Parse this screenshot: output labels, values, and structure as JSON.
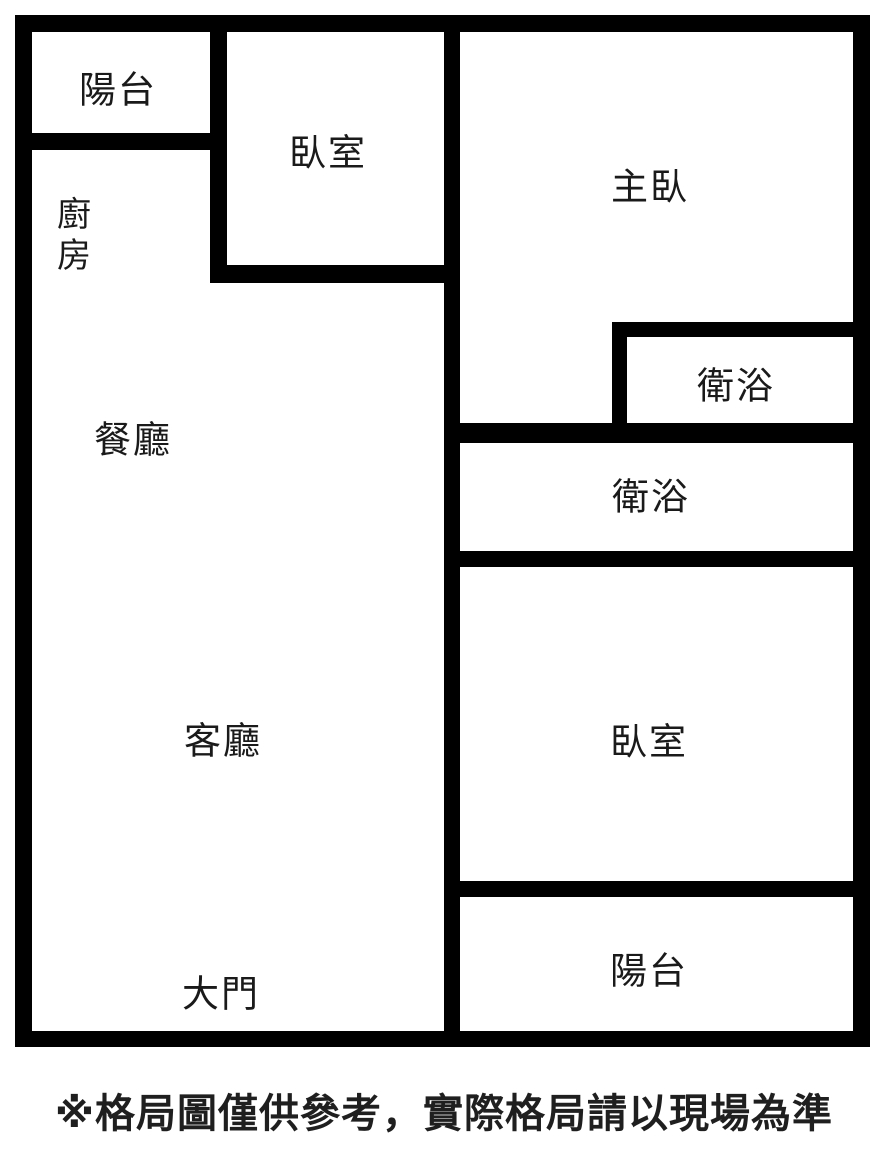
{
  "floorplan": {
    "rooms": {
      "balcony_top": "陽台",
      "bedroom_top": "臥室",
      "master_bedroom": "主臥",
      "kitchen_char1": "廚",
      "kitchen_char2": "房",
      "dining_room": "餐廳",
      "bathroom_upper": "衛浴",
      "bathroom_lower": "衛浴",
      "living_room": "客廳",
      "bedroom_right": "臥室",
      "balcony_bottom": "陽台",
      "main_door": "大門"
    },
    "footer_note": "※格局圖僅供參考，實際格局請以現場為準",
    "colors": {
      "wall": "#000000",
      "background": "#ffffff",
      "label_text": "#1a1a1a"
    }
  }
}
